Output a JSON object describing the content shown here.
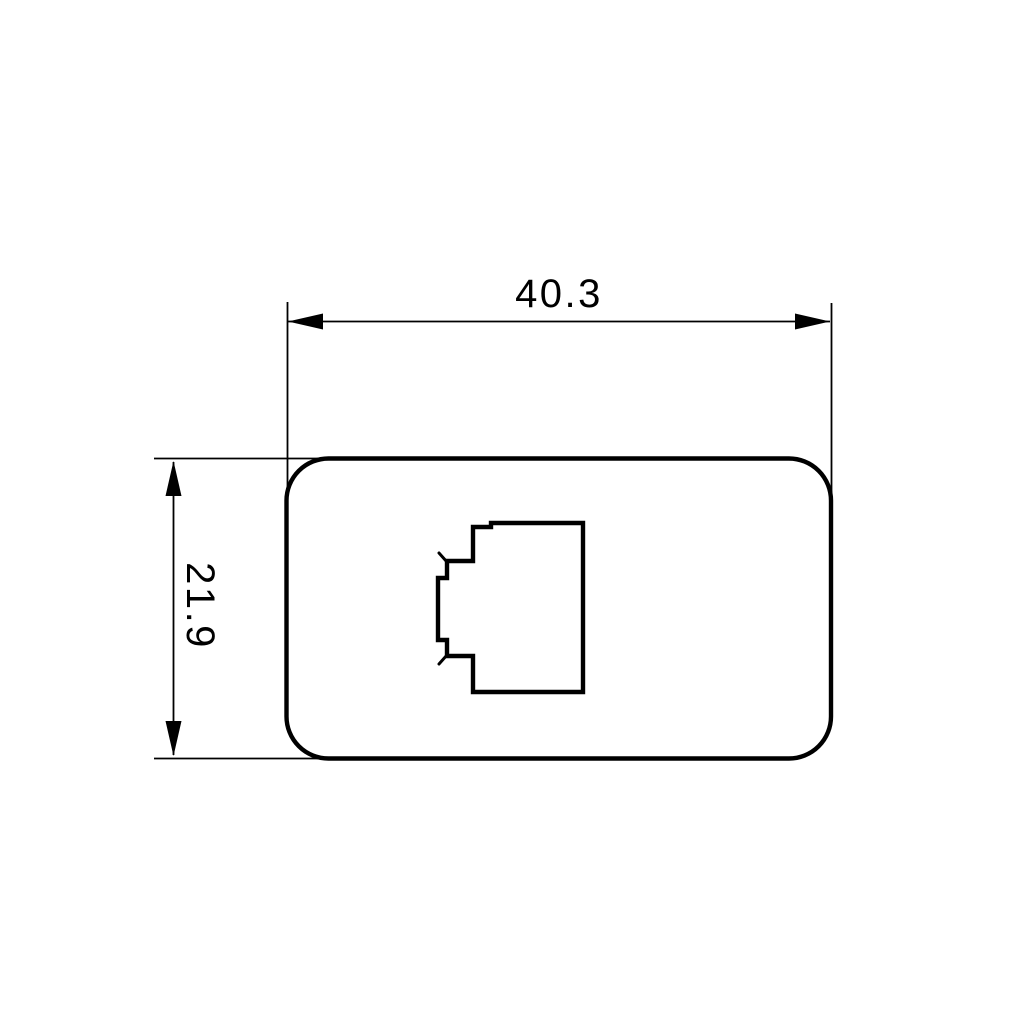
{
  "drawing": {
    "description": "Dimensioned CAD front view of a rounded-rectangle faceplate with a modular-jack (RJ) cutout",
    "background_color": "#ffffff",
    "line_color": "#000000",
    "width_dimension": {
      "value": "40.3"
    },
    "height_dimension": {
      "value": "21.9"
    }
  }
}
